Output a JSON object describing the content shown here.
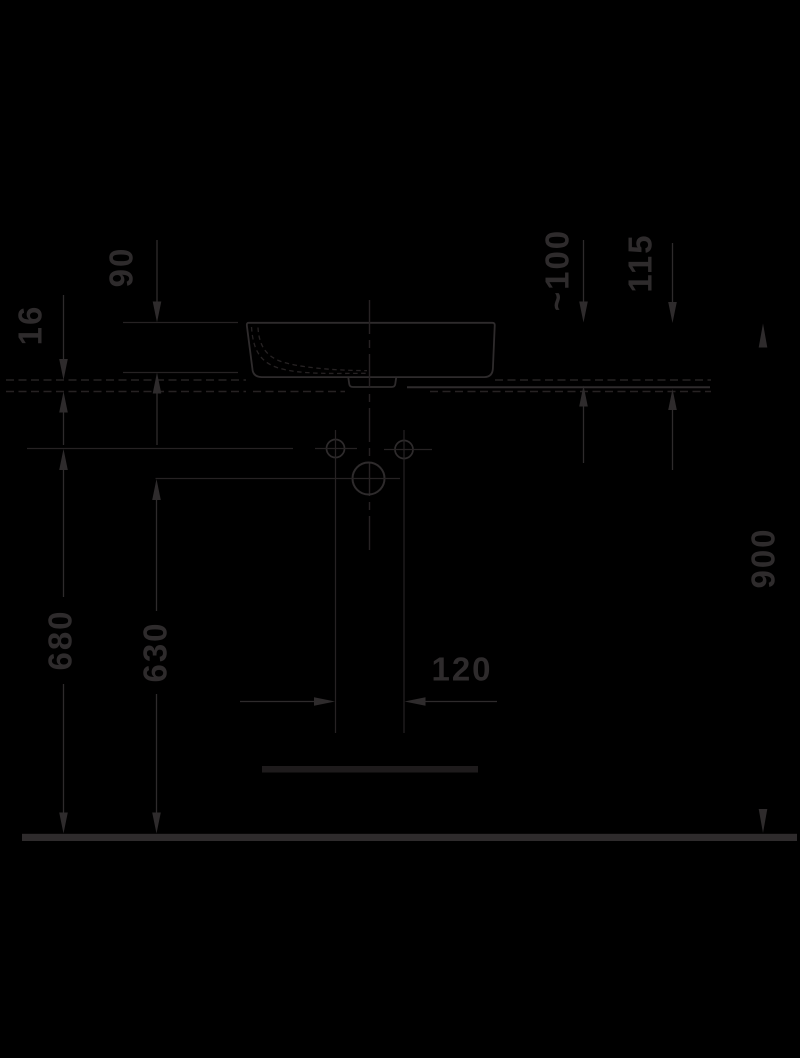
{
  "colors": {
    "bg": "#000000",
    "ink": "#2e2b2c",
    "line": "#262223",
    "faint": "#1e1b1c"
  },
  "drawing": {
    "type": "technical-installation-drawing",
    "subject": "washbasin side elevation with countertop, wall holes and floor reference",
    "units": "mm"
  },
  "dimensions": [
    {
      "id": "basin-rim-to-bottom",
      "label": "90",
      "orientation": "vertical"
    },
    {
      "id": "counter-thickness",
      "label": "16",
      "orientation": "vertical"
    },
    {
      "id": "rim-above-counter-top",
      "label": "~100",
      "orientation": "vertical"
    },
    {
      "id": "rim-above-counter-underside",
      "label": "115",
      "orientation": "vertical"
    },
    {
      "id": "rim-height-above-floor",
      "label": "900",
      "orientation": "vertical"
    },
    {
      "id": "supply-holes-height",
      "label": "680",
      "orientation": "vertical"
    },
    {
      "id": "drain-hole-height",
      "label": "630",
      "orientation": "vertical"
    },
    {
      "id": "supply-holes-spacing",
      "label": "120",
      "orientation": "horizontal"
    }
  ]
}
